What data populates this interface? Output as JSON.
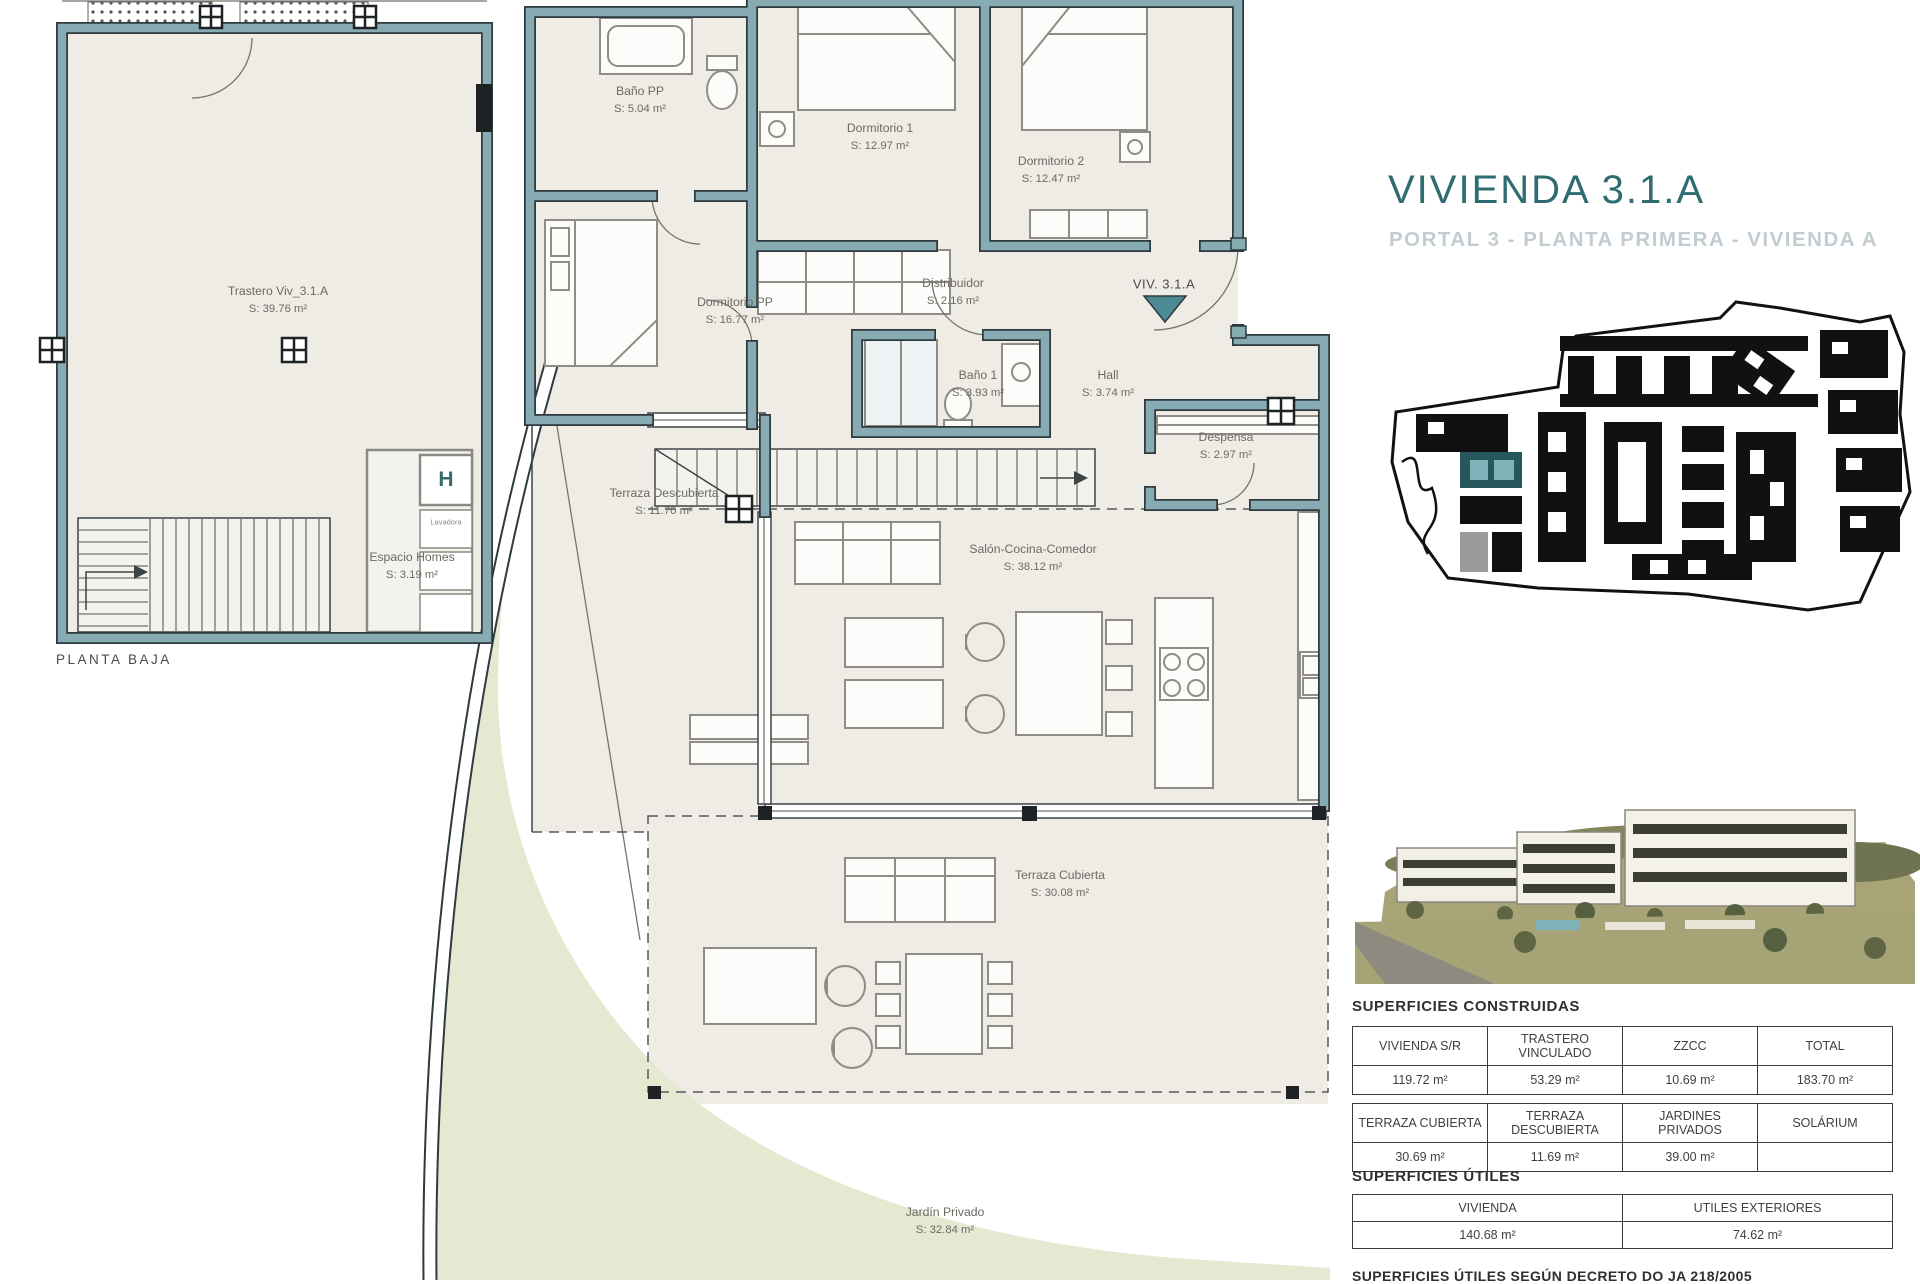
{
  "header": {
    "title": "VIVIENDA 3.1.A",
    "subtitle": "PORTAL 3 - PLANTA PRIMERA - VIVIENDA A"
  },
  "colors": {
    "wall_teal": "#87ABB3",
    "floor_beige": "#EFECE5",
    "garden_green": "#E5E9D2",
    "accent_teal": "#2F6C71",
    "subtitle_gray": "#C2CCD1",
    "siteplan_highlight": "#4E8A93"
  },
  "plans": {
    "baja": {
      "caption": "PLANTA BAJA",
      "rooms": {
        "trastero": {
          "name": "Trastero Viv_3.1.A",
          "area": "S: 39.76 m²"
        },
        "espacio_homes": {
          "name": "Espacio Homes",
          "area": "S: 3.19 m²"
        }
      },
      "labels": {
        "h_box": "H",
        "lavadora": "Lavadora"
      }
    },
    "primera": {
      "entrance_label": "VIV. 3.1.A",
      "rooms": {
        "bano_pp": {
          "name": "Baño PP",
          "area": "S: 5.04 m²"
        },
        "dormitorio1": {
          "name": "Dormitorio 1",
          "area": "S: 12.97 m²"
        },
        "dormitorio2": {
          "name": "Dormitorio 2",
          "area": "S: 12.47 m²"
        },
        "dormitorio_pp": {
          "name": "Dormitorio PP",
          "area": "S: 16.77 m²"
        },
        "distribuidor": {
          "name": "Distribuidor",
          "area": "S: 2.16 m²"
        },
        "bano1": {
          "name": "Baño 1",
          "area": "S: 3.93 m²"
        },
        "hall": {
          "name": "Hall",
          "area": "S: 3.74 m²"
        },
        "despensa": {
          "name": "Despensa",
          "area": "S: 2.97 m²"
        },
        "terraza_descubierta": {
          "name": "Terraza Descubierta",
          "area": "S: 11.70 m²"
        },
        "salon": {
          "name": "Salón-Cocina-Comedor",
          "area": "S: 38.12 m²"
        },
        "terraza_cubierta": {
          "name": "Terraza Cubierta",
          "area": "S: 30.08 m²"
        },
        "jardin": {
          "name": "Jardín Privado",
          "area": "S: 32.84 m²"
        }
      }
    }
  },
  "tables": {
    "construidas": {
      "heading": "SUPERFICIES CONSTRUIDAS",
      "t1": {
        "headers": [
          "VIVIENDA S/R",
          "TRASTERO VINCULADO",
          "ZZCC",
          "TOTAL"
        ],
        "values": [
          "119.72 m²",
          "53.29 m²",
          "10.69 m²",
          "183.70 m²"
        ]
      },
      "t2": {
        "headers": [
          "TERRAZA CUBIERTA",
          "TERRAZA DESCUBIERTA",
          "JARDINES PRIVADOS",
          "SOLÁRIUM"
        ],
        "values": [
          "30.69 m²",
          "11.69 m²",
          "39.00 m²",
          ""
        ]
      }
    },
    "utiles": {
      "heading": "SUPERFICIES ÚTILES",
      "headers": [
        "VIVIENDA",
        "UTILES EXTERIORES"
      ],
      "values": [
        "140.68 m²",
        "74.62 m²"
      ]
    },
    "footnote": "SUPERFICIES ÚTILES SEGÚN DECRETO DO JA 218/2005"
  }
}
